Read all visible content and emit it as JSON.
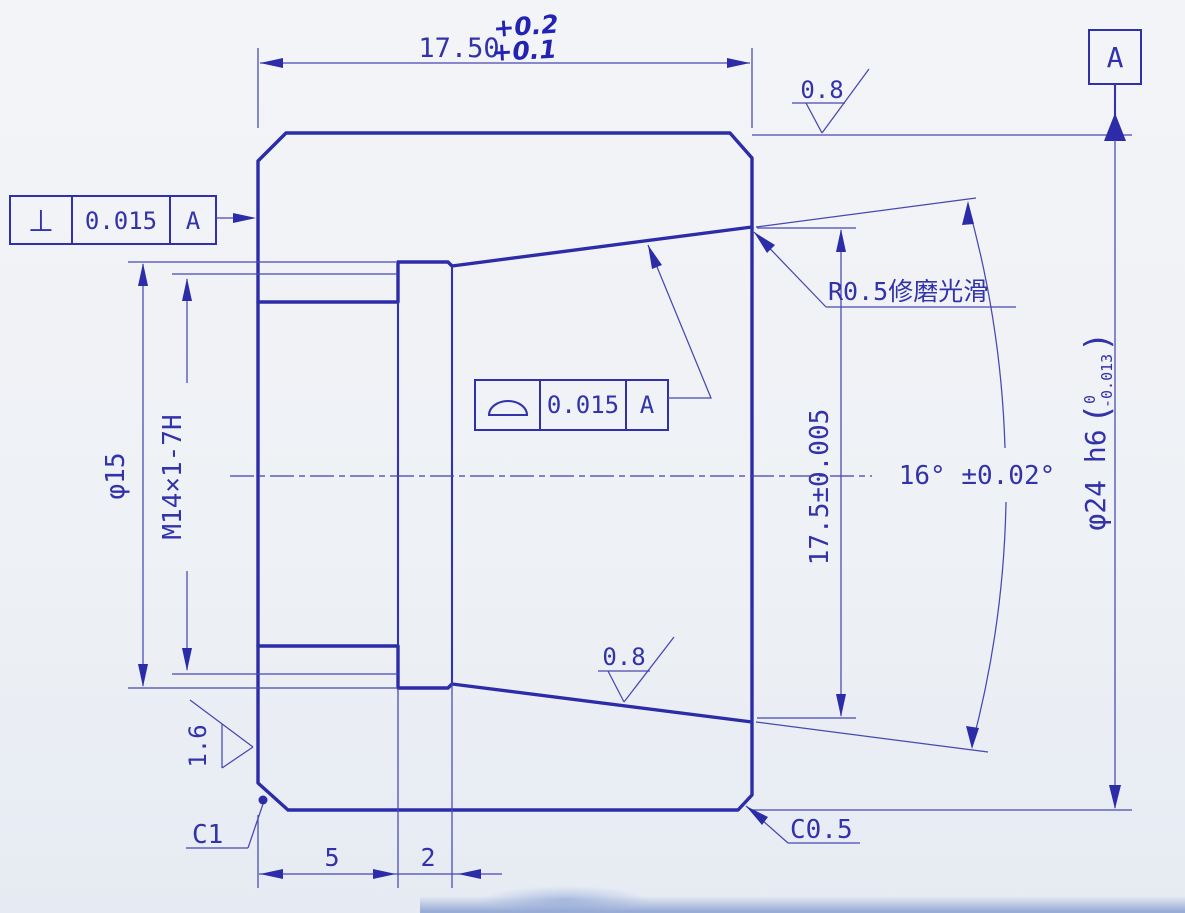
{
  "dims": {
    "total_length": "17.50",
    "total_length_tol_upper": "+0.2",
    "total_length_tol_lower": "+0.1",
    "thread_length": "5",
    "groove_width": "2",
    "groove_dia": "φ15",
    "thread_spec": "M14×1-7H",
    "mouth_dia": "17.5±0.005",
    "cone_angle": "16° ±0.02°",
    "outer_dia": "φ24 h6",
    "outer_dia_tol_upper": "0",
    "outer_dia_tol_lower": "-0.013",
    "outer_dia_paren_open": "(",
    "outer_dia_paren_close": ")",
    "chamfer_bottom_left": "C1",
    "chamfer_bottom_right": "C0.5"
  },
  "gdt": {
    "perpendicularity": {
      "symbol": "⊥",
      "tolerance": "0.015",
      "datum": "A"
    },
    "profile": {
      "tolerance": "0.015",
      "datum": "A"
    },
    "datum_label": "A"
  },
  "surface": {
    "top_face": "0.8",
    "cone_face": "0.8",
    "left_face": "1.6"
  },
  "notes": {
    "fillet": "R0.5修磨光滑"
  },
  "colors": {
    "ink": "#3232aa",
    "outline": "#2c2ca8",
    "paper": "#f0f2f5"
  }
}
